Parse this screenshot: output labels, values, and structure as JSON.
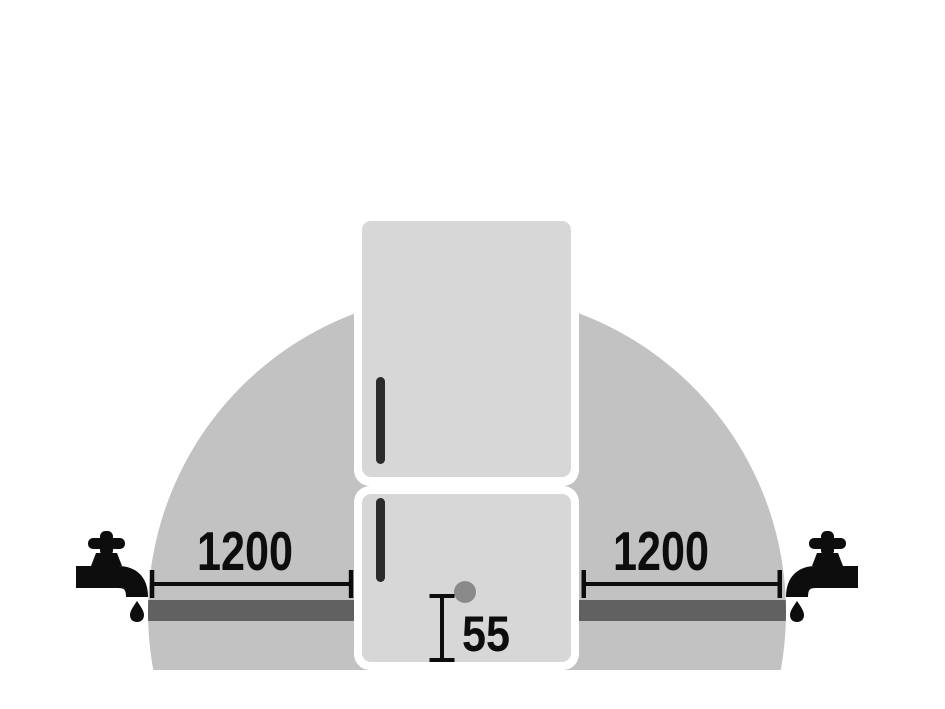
{
  "diagram": {
    "type": "refrigerator-water-connection-clearance",
    "clearance_left": {
      "value": "1200"
    },
    "clearance_right": {
      "value": "1200"
    },
    "hose_height": {
      "value": "55"
    },
    "colors": {
      "background": "#ffffff",
      "dome": "#c2c2c2",
      "band": "#616161",
      "margin": "#ffffff",
      "door": "#d7d7d7",
      "handle": "#2b2b2b",
      "dot": "#8a8a8a",
      "ink": "#0d0d0d"
    }
  }
}
